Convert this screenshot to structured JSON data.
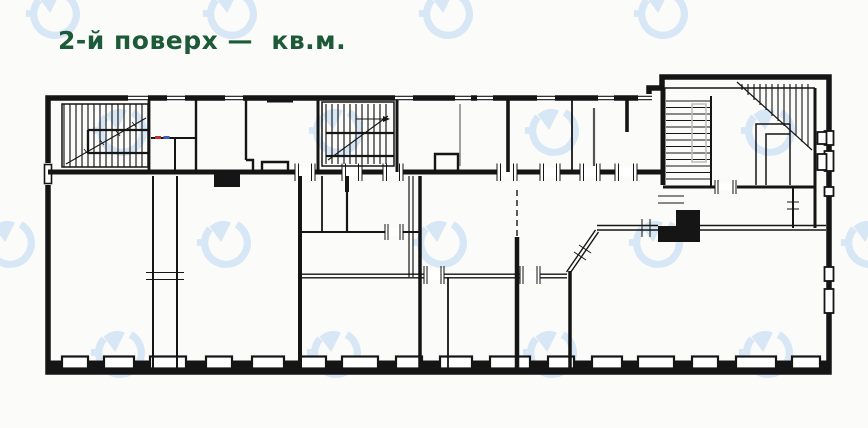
{
  "header": {
    "title": "2-й поверх —  кв.м.",
    "floor_label": "2-й поверх",
    "units_label": "кв.м.",
    "title_color": "#1d5a38"
  },
  "plan": {
    "type": "architectural-floor-plan",
    "wall_color": "#151515",
    "background_color": "#fbfbf9",
    "watermark_color": "#cfe3f5",
    "fixture_marks": {
      "red": "#c03030",
      "blue": "#3a5fc0"
    },
    "features": [
      "left-staircase",
      "center-staircase",
      "top-right-staircase-flight",
      "top-right-winder-staircase",
      "corridor",
      "window-band-bottom-wall",
      "diagonal-wall",
      "dashed-wall-segment"
    ]
  },
  "icons": [
    {
      "name": "watermark-logo-icon",
      "glyph": "circular-arrow-ring"
    }
  ]
}
